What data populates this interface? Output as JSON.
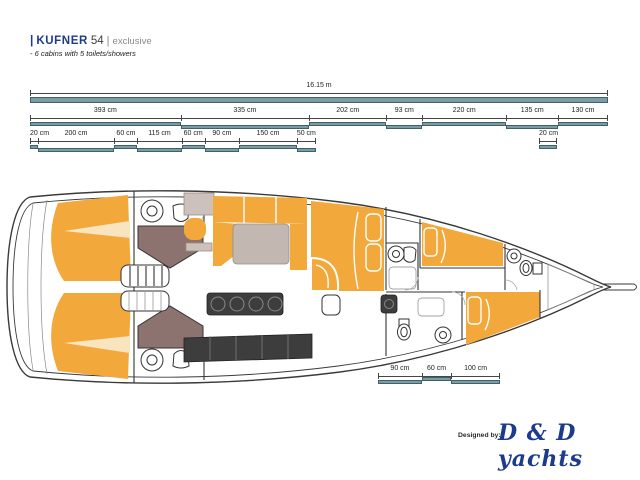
{
  "title": {
    "prefix_bar": "|",
    "brand": "KUFNER",
    "model": "54",
    "separator": "|",
    "edition": "exclusive",
    "subtitle": "- 6 cabins with 5 toilets/showers"
  },
  "footer": {
    "designed_by": "Designed by:",
    "studio": "D & D yachts"
  },
  "colors": {
    "navy": "#1c3b8b",
    "accent_orange": "#f2a83b",
    "accent_orange_light": "#f8e5bf",
    "taupe_dark": "#8c7370",
    "taupe_light": "#ccc1bb",
    "table_gray": "#c3b7b1",
    "counter_dark": "#3d3d3d",
    "teal_bar": "#7a9ca3"
  },
  "dimension_rows": [
    {
      "id": "overall",
      "segments": [
        {
          "label": "16.15 m",
          "cm": 1615
        }
      ]
    },
    {
      "id": "sections",
      "segments": [
        {
          "label": "393 cm",
          "cm": 393
        },
        {
          "label": "335 cm",
          "cm": 335
        },
        {
          "label": "202 cm",
          "cm": 202
        },
        {
          "label": "93 cm",
          "cm": 93
        },
        {
          "label": "220 cm",
          "cm": 220
        },
        {
          "label": "135 cm",
          "cm": 135
        },
        {
          "label": "130 cm",
          "cm": 130
        }
      ]
    },
    {
      "id": "details",
      "segments": [
        {
          "label": "20 cm",
          "cm": 20
        },
        {
          "label": "200 cm",
          "cm": 200
        },
        {
          "label": "60 cm",
          "cm": 60
        },
        {
          "label": "115 cm",
          "cm": 115
        },
        {
          "label": "60 cm",
          "cm": 60
        },
        {
          "label": "90 cm",
          "cm": 90
        },
        {
          "label": "150 cm",
          "cm": 150
        },
        {
          "label": "50 cm",
          "cm": 50
        }
      ]
    },
    {
      "id": "detail-right",
      "segments": [
        {
          "label": "20 cm",
          "cm": 20
        }
      ]
    },
    {
      "id": "bow",
      "segments": [
        {
          "label": "90 cm",
          "cm": 90
        },
        {
          "label": "60 cm",
          "cm": 60
        },
        {
          "label": "100 cm",
          "cm": 100
        }
      ]
    }
  ]
}
